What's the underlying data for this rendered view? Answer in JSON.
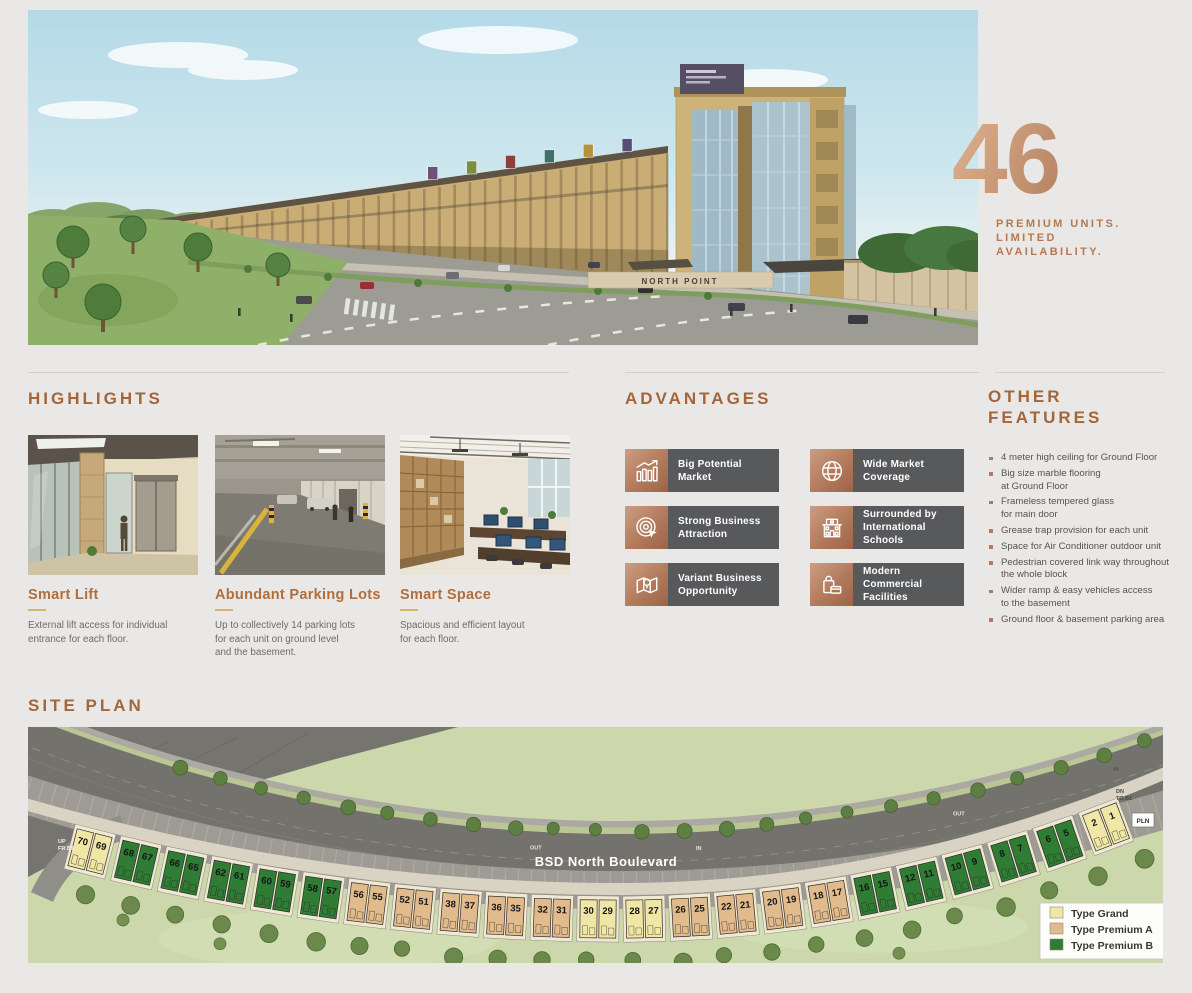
{
  "hero": {
    "building_sign": "NORTH POINT",
    "stat_number": "46",
    "stat_caption_lines": [
      "PREMIUM UNITS.",
      "LIMITED",
      "AVAILABILITY."
    ]
  },
  "highlights": {
    "title": "HIGHLIGHTS",
    "cards": [
      {
        "image": "smart-lift-photo",
        "title": "Smart Lift",
        "description": "External lift access for individual\nentrance for each floor."
      },
      {
        "image": "parking-garage-photo",
        "title": "Abundant Parking Lots",
        "description": "Up to collectively 14 parking lots\nfor each unit on ground level\nand the basement."
      },
      {
        "image": "office-space-photo",
        "title": "Smart Space",
        "description": "Spacious and efficient layout\nfor each floor."
      }
    ]
  },
  "advantages": {
    "title": "ADVANTAGES",
    "panel_color": "#58595b",
    "icon_color": "#b27a5c",
    "items": [
      {
        "icon": "bar-chart-growth-icon",
        "label": "Big Potential\nMarket"
      },
      {
        "icon": "globe-icon",
        "label": "Wide Market\nCoverage"
      },
      {
        "icon": "target-cursor-icon",
        "label": "Strong Business\nAttraction"
      },
      {
        "icon": "school-building-icon",
        "label": "Surrounded by\nInternational Schools"
      },
      {
        "icon": "map-location-icon",
        "label": "Variant Business\nOpportunity"
      },
      {
        "icon": "shopping-bag-card-icon",
        "label": "Modern Commercial\nFacilities"
      }
    ]
  },
  "other_features": {
    "title_lines": [
      "OTHER",
      "FEATURES"
    ],
    "items": [
      "4 meter high ceiling for Ground Floor",
      "Big size marble flooring\nat Ground Floor",
      "Frameless tempered glass\nfor main door",
      "Grease trap provision for each unit",
      "Space for Air Conditioner outdoor unit",
      "Pedestrian covered link way throughout\nthe whole block",
      "Wider ramp & easy vehicles access\nto the basement",
      "Ground floor & basement parking area"
    ]
  },
  "site_plan": {
    "title": "SITE PLAN",
    "road_label": "BSD North Boulevard",
    "labels": {
      "up_left": "UP\nFR B1",
      "out_mid": "OUT",
      "in_mid": "IN",
      "out_right": "OUT",
      "in_right": "IN",
      "down_right": "DN\nTO B1",
      "pln": "PLN"
    },
    "type_colors": {
      "grand": "#f0e6a6",
      "premium_a": "#e2bb8d",
      "premium_b": "#2f7c35"
    },
    "blocks": [
      {
        "units": [
          "70",
          "69"
        ],
        "type": "grand"
      },
      {
        "units": [
          "68",
          "67"
        ],
        "type": "premium_b"
      },
      {
        "units": [
          "66",
          "65"
        ],
        "type": "premium_b"
      },
      {
        "units": [
          "62",
          "61"
        ],
        "type": "premium_b"
      },
      {
        "units": [
          "60",
          "59"
        ],
        "type": "premium_b"
      },
      {
        "units": [
          "58",
          "57"
        ],
        "type": "premium_b"
      },
      {
        "units": [
          "56",
          "55"
        ],
        "type": "premium_a"
      },
      {
        "units": [
          "52",
          "51"
        ],
        "type": "premium_a"
      },
      {
        "units": [
          "38",
          "37"
        ],
        "type": "premium_a"
      },
      {
        "units": [
          "36",
          "35"
        ],
        "type": "premium_a"
      },
      {
        "units": [
          "32",
          "31"
        ],
        "type": "premium_a"
      },
      {
        "units": [
          "30",
          "29"
        ],
        "type": "grand"
      },
      {
        "units": [
          "28",
          "27"
        ],
        "type": "grand"
      },
      {
        "units": [
          "26",
          "25"
        ],
        "type": "premium_a"
      },
      {
        "units": [
          "22",
          "21"
        ],
        "type": "premium_a"
      },
      {
        "units": [
          "20",
          "19"
        ],
        "type": "premium_a"
      },
      {
        "units": [
          "18",
          "17"
        ],
        "type": "premium_a"
      },
      {
        "units": [
          "16",
          "15"
        ],
        "type": "premium_b"
      },
      {
        "units": [
          "12",
          "11"
        ],
        "type": "premium_b"
      },
      {
        "units": [
          "10",
          "9"
        ],
        "type": "premium_b"
      },
      {
        "units": [
          "8",
          "7"
        ],
        "type": "premium_b"
      },
      {
        "units": [
          "6",
          "5"
        ],
        "type": "premium_b"
      },
      {
        "units": [
          "2",
          "1"
        ],
        "type": "grand"
      }
    ],
    "legend": [
      {
        "label": "Type Grand",
        "type": "grand"
      },
      {
        "label": "Type Premium A",
        "type": "premium_a"
      },
      {
        "label": "Type Premium B",
        "type": "premium_b"
      }
    ]
  }
}
